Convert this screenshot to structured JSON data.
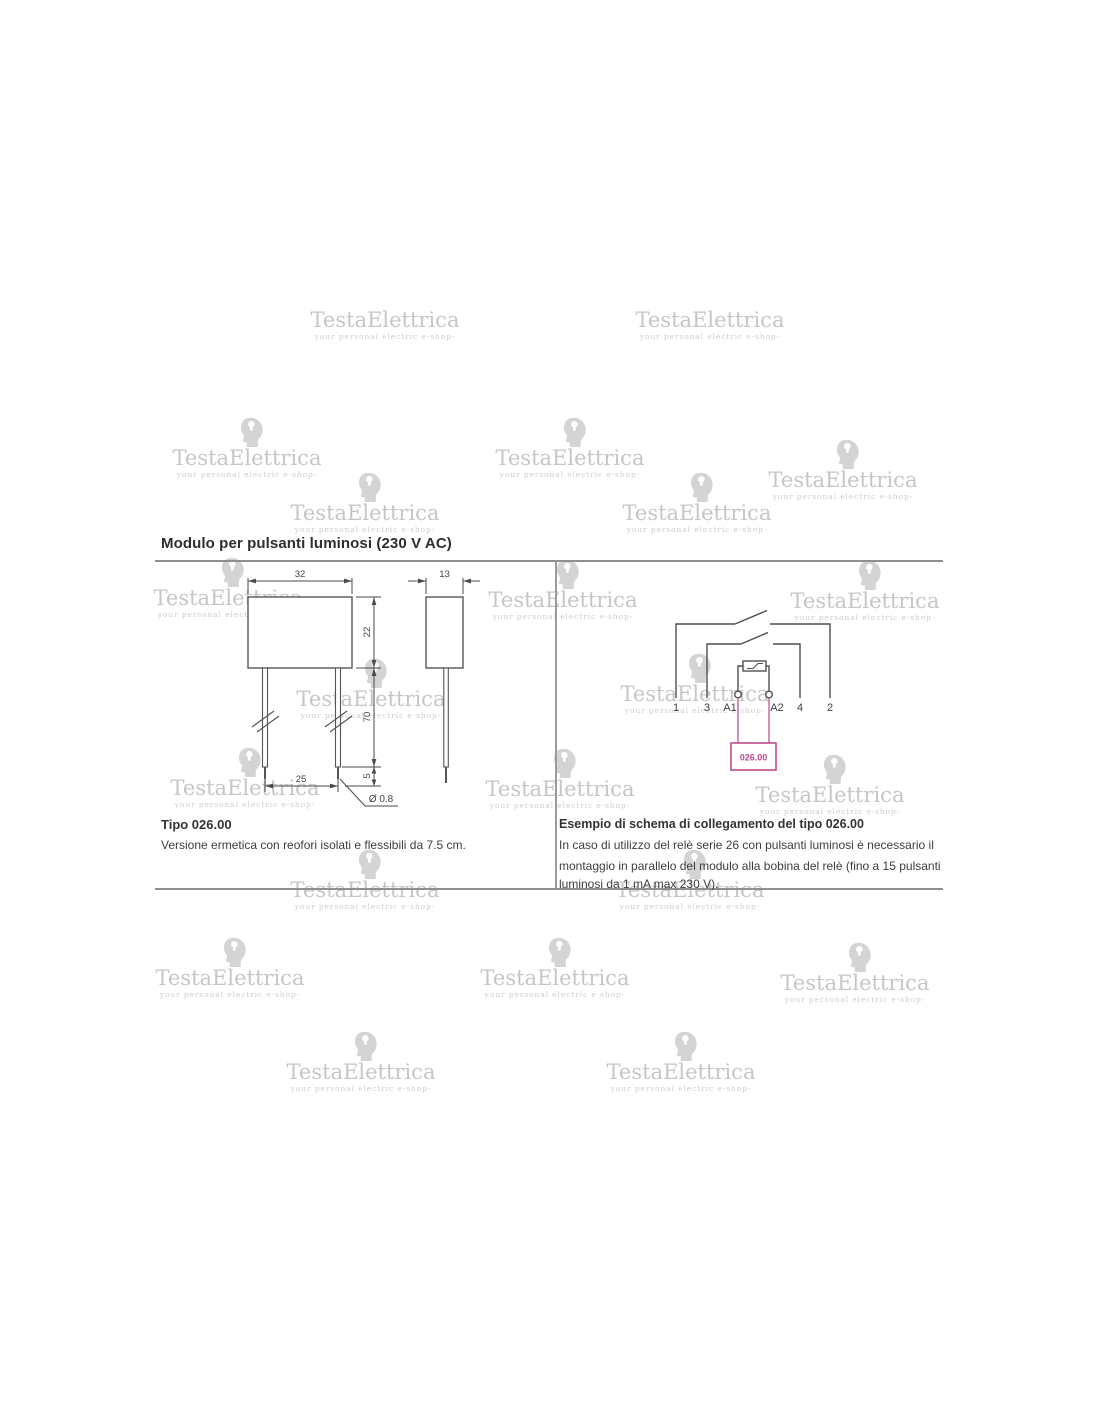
{
  "watermark": {
    "brand": "TestaElettrica",
    "tagline": "your personal electric e-shop-"
  },
  "page": {
    "title": "Modulo per pulsanti luminosi (230 V AC)"
  },
  "left_panel": {
    "type_label": "Tipo 026.00",
    "description": "Versione ermetica con reofori isolati e flessibili da 7.5 cm.",
    "drawing": {
      "front_width_mm": "32",
      "front_height_mm": "22",
      "side_width_mm": "13",
      "lead_length_mm": "70",
      "lead_tip_mm": "5",
      "lead_pitch_mm": "25",
      "wire_diameter": "Ø 0.8"
    }
  },
  "right_panel": {
    "heading": "Esempio di schema di collegamento del tipo 026.00",
    "body_lines": [
      "In caso di utilizzo del relè serie 26 con pulsanti luminosi è necessario il",
      "montaggio in parallelo del modulo alla bobina del relè (fino a 15 pulsanti",
      "luminosi da 1 mA max 230 V)."
    ],
    "schematic": {
      "terminals": [
        "1",
        "3",
        "A1",
        "A2",
        "4",
        "2"
      ],
      "module_label": "026.00"
    }
  },
  "colors": {
    "accent_pink": "#bf4a8c",
    "line_gray": "#4f4f4f",
    "watermark_gray": "#c6c6c6"
  }
}
